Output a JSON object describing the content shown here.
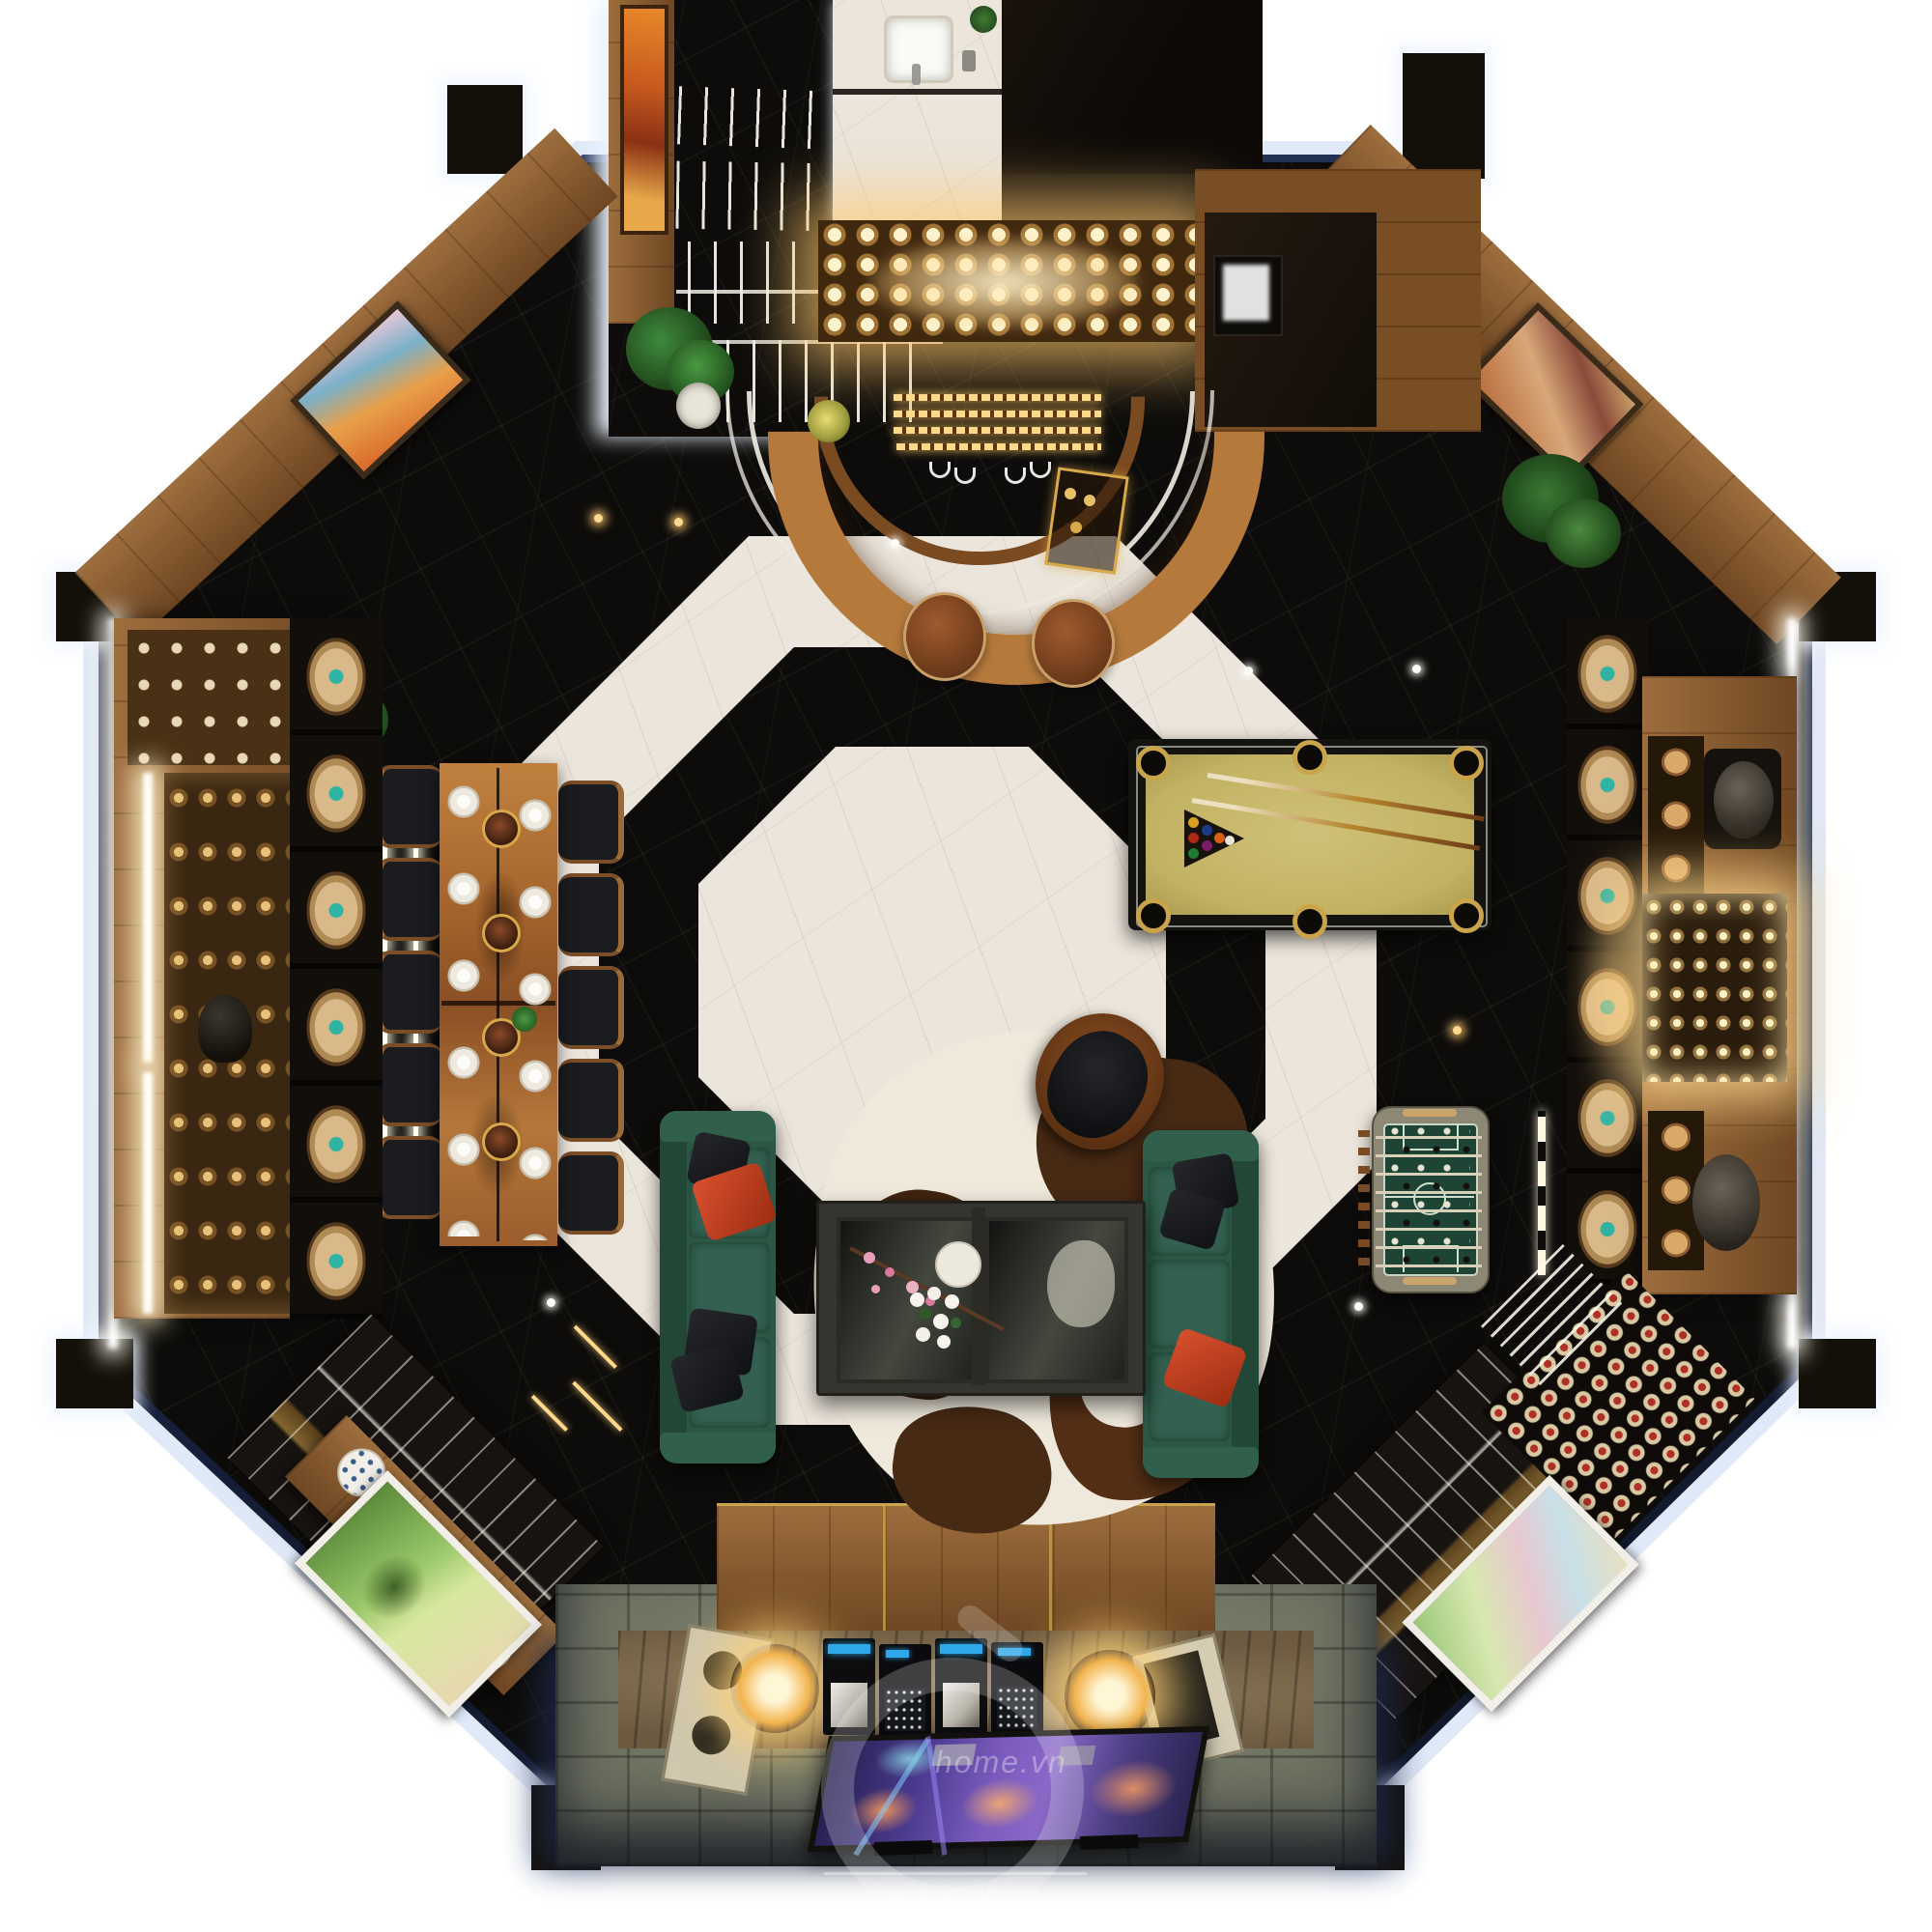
{
  "meta": {
    "title": "octagonal-lounge-top-down-render"
  },
  "watermark": {
    "brand": "home.vn",
    "caption": "home & interior"
  },
  "palette": {
    "background": "#ffffff",
    "edge_glow": "#dfe9f8",
    "edge_rim_navy": "#1c2a4a",
    "black_marble": "#0d0c0a",
    "white_marble": "#ebe5db",
    "wood": "#8a5a2e",
    "bar_counter_wood": "#b5793c",
    "sofa_green": "#2c5745",
    "pillow_red": "#c8401f",
    "pillow_black": "#1b1c1e",
    "pool_felt": "#c9ba69",
    "pool_pocket_gold": "#caa44a",
    "foosball_field": "#1d4434",
    "cowhide_brown": "#472a14",
    "cowhide_white": "#efe9dc",
    "warm_glow": "#ffd98f",
    "stone_patio": "#6d7160",
    "stone_wall": "#6e5a40",
    "tv_screen_purple": "#6b4fb0",
    "porcelain_blue": "#3a5c8c",
    "jar_teal": "#2fb3a3"
  },
  "objects": [
    "octagonal lounge room",
    "curved bar counter",
    "back bar liquor glow shelf",
    "bathroom vanity with sink",
    "staircase hallway",
    "pool table with cues and ball rack",
    "foosball table",
    "two green leather sofas",
    "red and black accent pillows",
    "glass coffee table with flowers",
    "cowhide rug",
    "leather swivel armchair",
    "live-edge dining table",
    "dining chairs",
    "copper pendant lamps",
    "wine jar racks",
    "illuminated display cabinets",
    "wine bottle rack",
    "porcelain vases console",
    "wall paintings",
    "potted plants",
    "tv wall with speakers and amplifiers",
    "stone patio",
    "photographer watermark"
  ]
}
